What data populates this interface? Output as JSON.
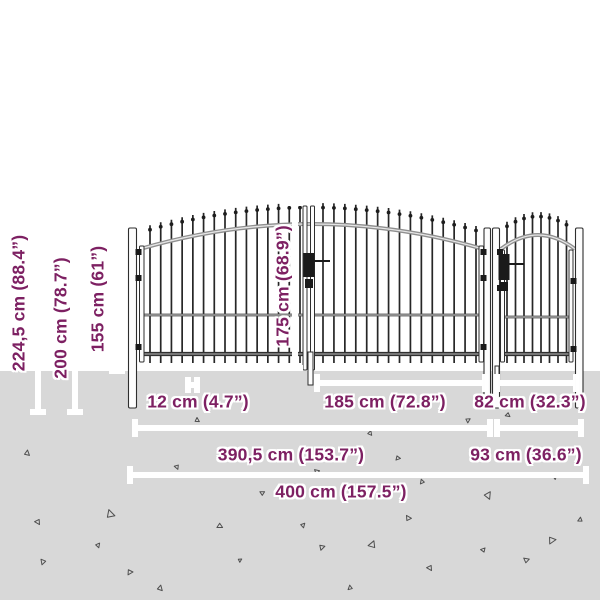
{
  "image_type": "fence-gate-dimension-diagram",
  "colors": {
    "accent": "#7d2062",
    "ground": "#d8d8d8",
    "sky": "#ffffff",
    "gate_metal": "#262626"
  },
  "dimensions": {
    "total_height": "224,5 cm (88.4”)",
    "post_height": "200 cm (78.7”)",
    "fence_height": "155 cm (61”)",
    "gate_leaf_height": "175 cm (68.9”)",
    "post_width": "12 cm (4.7”)",
    "leaf_width": "185 cm (72.8”)",
    "wicket_leaf_width": "82 cm (32.3”)",
    "double_gate_width": "390,5 cm (153.7”)",
    "wicket_gate_width": "93 cm (36.6”)",
    "total_width": "400 cm (157.5”)"
  }
}
